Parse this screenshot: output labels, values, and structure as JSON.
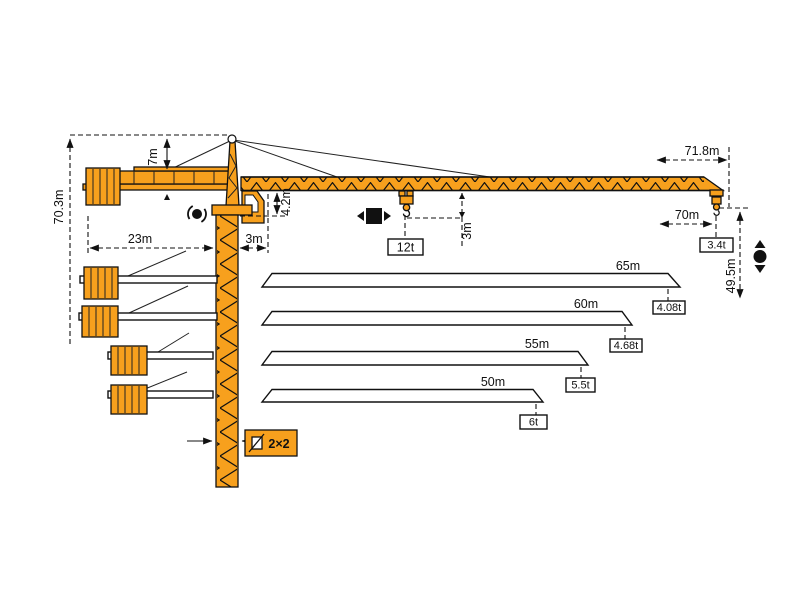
{
  "diagram": {
    "colors": {
      "crane_orange": "#F7A01D",
      "outline": "#111111",
      "background": "#FFFFFF"
    },
    "main_view": {
      "total_height": "70.3m",
      "tower_head_height": "7m",
      "counter_jib_length": "23m",
      "jib_rear_offset": "3m",
      "jib_root_height": "4.2m",
      "max_load": "12t",
      "hook_clearance": "3m",
      "max_radius_overall": "71.8m",
      "max_radius": "70m",
      "tip_load": "3.4t",
      "hook_height": "49.5m",
      "mast_section": "2×2"
    },
    "jib_variants": [
      {
        "length": "65m",
        "tip_load": "4.08t"
      },
      {
        "length": "60m",
        "tip_load": "4.68t"
      },
      {
        "length": "55m",
        "tip_load": "5.5t"
      },
      {
        "length": "50m",
        "tip_load": "6t"
      }
    ],
    "icons": {
      "slewing": "slewing-rotation-icon",
      "trolley": "trolley-travel-icon",
      "hoist": "hoisting-icon",
      "mast_section": "mast-cross-section-icon"
    }
  }
}
